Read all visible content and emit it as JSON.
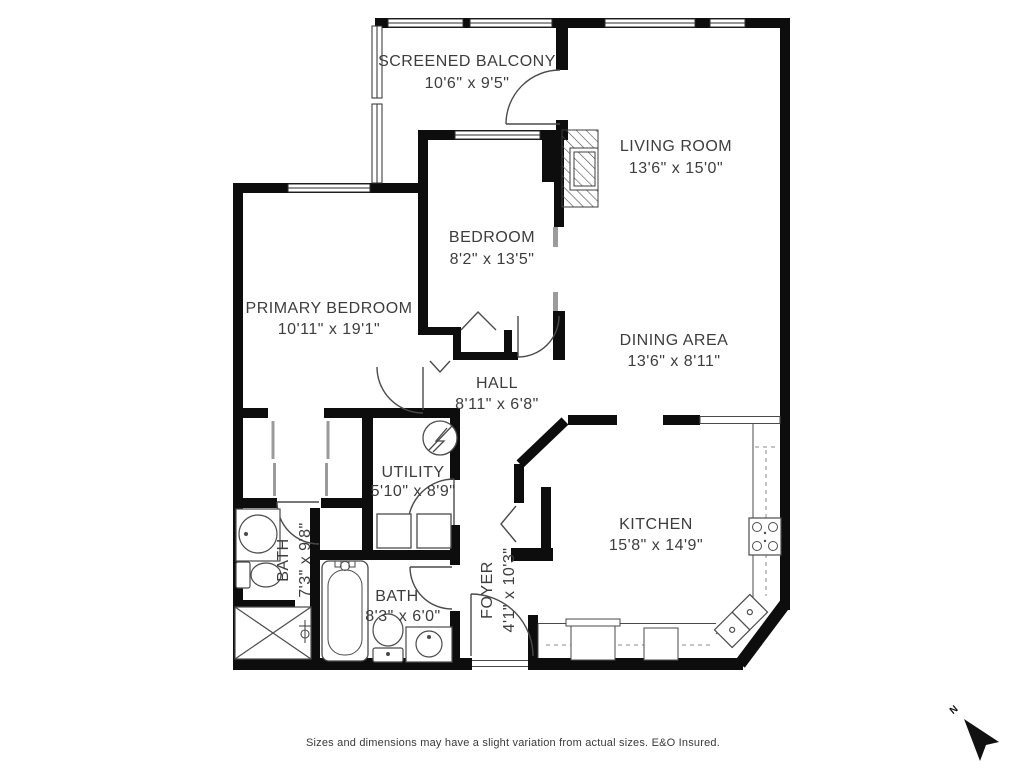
{
  "plan_title": "Condo Floor Plan",
  "rooms": {
    "balcony": {
      "label": "SCREENED BALCONY",
      "dims": "10'6\" x 9'5\""
    },
    "living": {
      "label": "LIVING ROOM",
      "dims": "13'6\" x 15'0\""
    },
    "bedroom": {
      "label": "BEDROOM",
      "dims": "8'2\" x 13'5\""
    },
    "primary": {
      "label": "PRIMARY BEDROOM",
      "dims": "10'11\" x 19'1\""
    },
    "dining": {
      "label": "DINING AREA",
      "dims": "13'6\" x 8'11\""
    },
    "hall": {
      "label": "HALL",
      "dims": "8'11\" x 6'8\""
    },
    "utility": {
      "label": "UTILITY",
      "dims": "5'10\" x 8'9\""
    },
    "bath_main": {
      "label": "BATH",
      "dims": "7'3\" x 9'8\""
    },
    "bath_second": {
      "label": "BATH",
      "dims": "8'3\" x 6'0\""
    },
    "foyer": {
      "label": "FOYER",
      "dims": "4'1\" x 10'3\""
    },
    "kitchen": {
      "label": "KITCHEN",
      "dims": "15'8\" x 14'9\""
    }
  },
  "compass": {
    "label": "N"
  },
  "footer": {
    "disclaimer": "Sizes and dimensions may have a slight variation from actual sizes. E&O Insured."
  },
  "colors": {
    "wall": "#0d0d0d",
    "text": "#3d3d3d",
    "fixture_line": "#4a4a4a",
    "window_gray": "#9b9b9b"
  }
}
